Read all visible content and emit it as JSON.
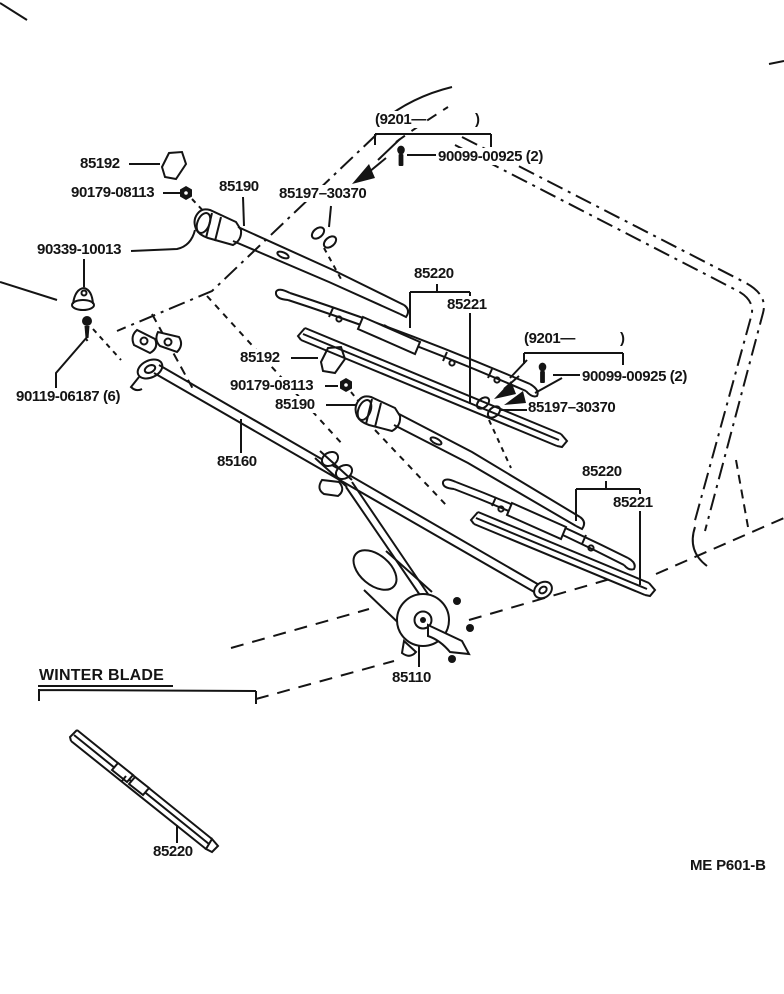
{
  "page": {
    "width": 784,
    "height": 994,
    "background": "#ffffff",
    "ink": "#141414"
  },
  "figure_code": "ME P601-B",
  "section_heading": "WINTER BLADE",
  "icons": [
    {
      "name": "screw-icon",
      "meaning": "pivot screw 90099-00925"
    },
    {
      "name": "nut-icon",
      "meaning": "arm nut 90179-08113"
    },
    {
      "name": "cap-icon",
      "meaning": "pivot cap 85192"
    },
    {
      "name": "grommet-icon",
      "meaning": "grommet 90339-10013"
    },
    {
      "name": "bolt-icon",
      "meaning": "bolt 90119-06187"
    },
    {
      "name": "clip-icon",
      "meaning": "arm clip 85197-30370"
    },
    {
      "name": "arrow-icon",
      "meaning": "points installed location"
    }
  ],
  "labels": [
    {
      "name": "note-9201-1-open",
      "text": "(9201—",
      "x": 374,
      "y": 111
    },
    {
      "name": "note-9201-1-close",
      "text": ")",
      "x": 474,
      "y": 111
    },
    {
      "name": "label-90099-1",
      "text": "90099-00925 (2)",
      "x": 437,
      "y": 148
    },
    {
      "name": "label-85192-1",
      "text": "85192",
      "x": 79,
      "y": 155
    },
    {
      "name": "label-90179-1",
      "text": "90179-08113",
      "x": 70,
      "y": 184
    },
    {
      "name": "label-85190-1",
      "text": "85190",
      "x": 218,
      "y": 178
    },
    {
      "name": "label-85197-1",
      "text": "85197–30370",
      "x": 278,
      "y": 185
    },
    {
      "name": "label-90339",
      "text": "90339-10013",
      "x": 36,
      "y": 241
    },
    {
      "name": "label-85220-1",
      "text": "85220",
      "x": 413,
      "y": 265
    },
    {
      "name": "label-85221-1",
      "text": "85221",
      "x": 446,
      "y": 296
    },
    {
      "name": "label-90119",
      "text": "90119-06187 (6)",
      "x": 15,
      "y": 388
    },
    {
      "name": "note-9201-2-open",
      "text": "(9201—",
      "x": 523,
      "y": 330
    },
    {
      "name": "note-9201-2-close",
      "text": ")",
      "x": 619,
      "y": 330
    },
    {
      "name": "label-90099-2",
      "text": "90099-00925 (2)",
      "x": 581,
      "y": 368
    },
    {
      "name": "label-85192-2",
      "text": "85192",
      "x": 239,
      "y": 349
    },
    {
      "name": "label-90179-2",
      "text": "90179-08113",
      "x": 229,
      "y": 377
    },
    {
      "name": "label-85190-2",
      "text": "85190",
      "x": 274,
      "y": 396
    },
    {
      "name": "label-85197-2",
      "text": "85197–30370",
      "x": 527,
      "y": 399
    },
    {
      "name": "label-85160",
      "text": "85160",
      "x": 216,
      "y": 453
    },
    {
      "name": "label-85220-2",
      "text": "85220",
      "x": 581,
      "y": 463
    },
    {
      "name": "label-85221-2",
      "text": "85221",
      "x": 612,
      "y": 494
    },
    {
      "name": "label-85110",
      "text": "85110",
      "x": 391,
      "y": 669
    },
    {
      "name": "heading-winter-blade",
      "text": "WINTER BLADE",
      "x": 38,
      "y": 667,
      "cls": "heading"
    },
    {
      "name": "label-85220-3",
      "text": "85220",
      "x": 152,
      "y": 843
    },
    {
      "name": "label-fig-code",
      "text": "ME P601-B",
      "x": 689,
      "y": 857,
      "cls": "code"
    }
  ]
}
